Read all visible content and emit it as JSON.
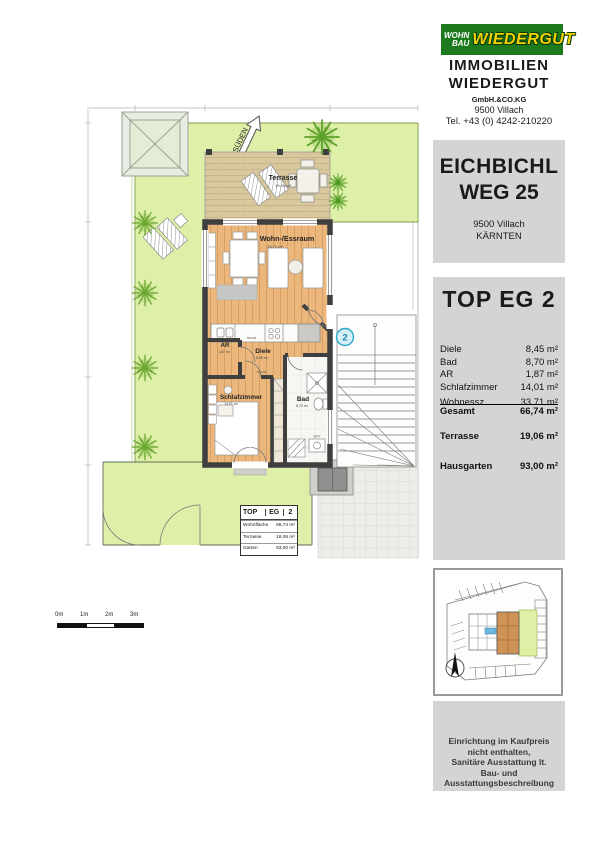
{
  "branding": {
    "logo_left_top": "WOHN",
    "logo_left_bottom": "BAU",
    "logo_right": "WIEDERGUT",
    "company_line1": "IMMOBILIEN",
    "company_line2": "WIEDERGUT",
    "company_sub": "GmbH.&CO.KG",
    "company_city": "9500 Villach",
    "company_tel": "Tel. +43 (0) 4242-210220"
  },
  "project": {
    "name_line1": "EICHBICHL",
    "name_line2": "WEG 25",
    "city": "9500 Villach",
    "region": "KÄRNTEN"
  },
  "unit": {
    "title": "TOP EG 2",
    "rooms": [
      {
        "label": "Diele",
        "value": "8,45 m²"
      },
      {
        "label": "Bad",
        "value": "8,70 m²"
      },
      {
        "label": "AR",
        "value": "1,87 m²"
      },
      {
        "label": "Schlafzimmer",
        "value": "14,01 m²"
      }
    ],
    "clipped_row": {
      "label": "Wohnessz.",
      "value": "33,71 m²"
    },
    "totals": [
      {
        "label": "Gesamt",
        "value": "66,74 m²"
      },
      {
        "label": "Terrasse",
        "value": "19,06 m²"
      },
      {
        "label": "Hausgarten",
        "value": "93,00 m²"
      }
    ]
  },
  "plan": {
    "north_label": "SÜDEN",
    "unit_marker": "2",
    "rooms": {
      "wohnessraum": {
        "label": "Wohn-/Essraum",
        "area": "33,71 m²"
      },
      "terrasse": {
        "label": "Terrasse",
        "area": "19,06 m²"
      },
      "ar": {
        "label": "AR",
        "area": "1,87 m²"
      },
      "diele": {
        "label": "Diele",
        "area": "8,45 m²"
      },
      "schlafzimmer": {
        "label": "Schlafzimmer",
        "area": "14,01 m²"
      },
      "bad": {
        "label": "Bad",
        "area": "8,70 m²"
      }
    },
    "door_labels": [
      "90/205",
      "80/205"
    ],
    "washer_label": "W+T",
    "legend": {
      "header": [
        "TOP",
        "EG",
        "2"
      ],
      "rows": [
        {
          "label": "Wohnfläche",
          "value": "66,74 m²"
        },
        {
          "label": "Terrasse",
          "value": "19,06 m²"
        },
        {
          "label": "Garten",
          "value": "93,00 m²"
        }
      ]
    },
    "scale_labels": [
      "0m",
      "1m",
      "2m",
      "3m"
    ]
  },
  "disclaimer": {
    "line1": "Einrichtung im Kaufpreis",
    "line2": "nicht enthalten,",
    "line3": "Sanitäre Ausstattung lt.",
    "line4": "Bau- und",
    "line5": "Ausstattungsbeschreibung"
  },
  "colors": {
    "logo_green": "#1c7a1c",
    "logo_yellow": "#f2d200",
    "garden_green": "#def0a8",
    "wood_interior": "#ecb77d",
    "wood_terrace": "#d9c89e",
    "wall_dark": "#3f3f3f",
    "panel_gray": "#d4d4d4",
    "unit_marker_blue": "#2aa8c8",
    "highlight_orange": "#cf9357"
  }
}
